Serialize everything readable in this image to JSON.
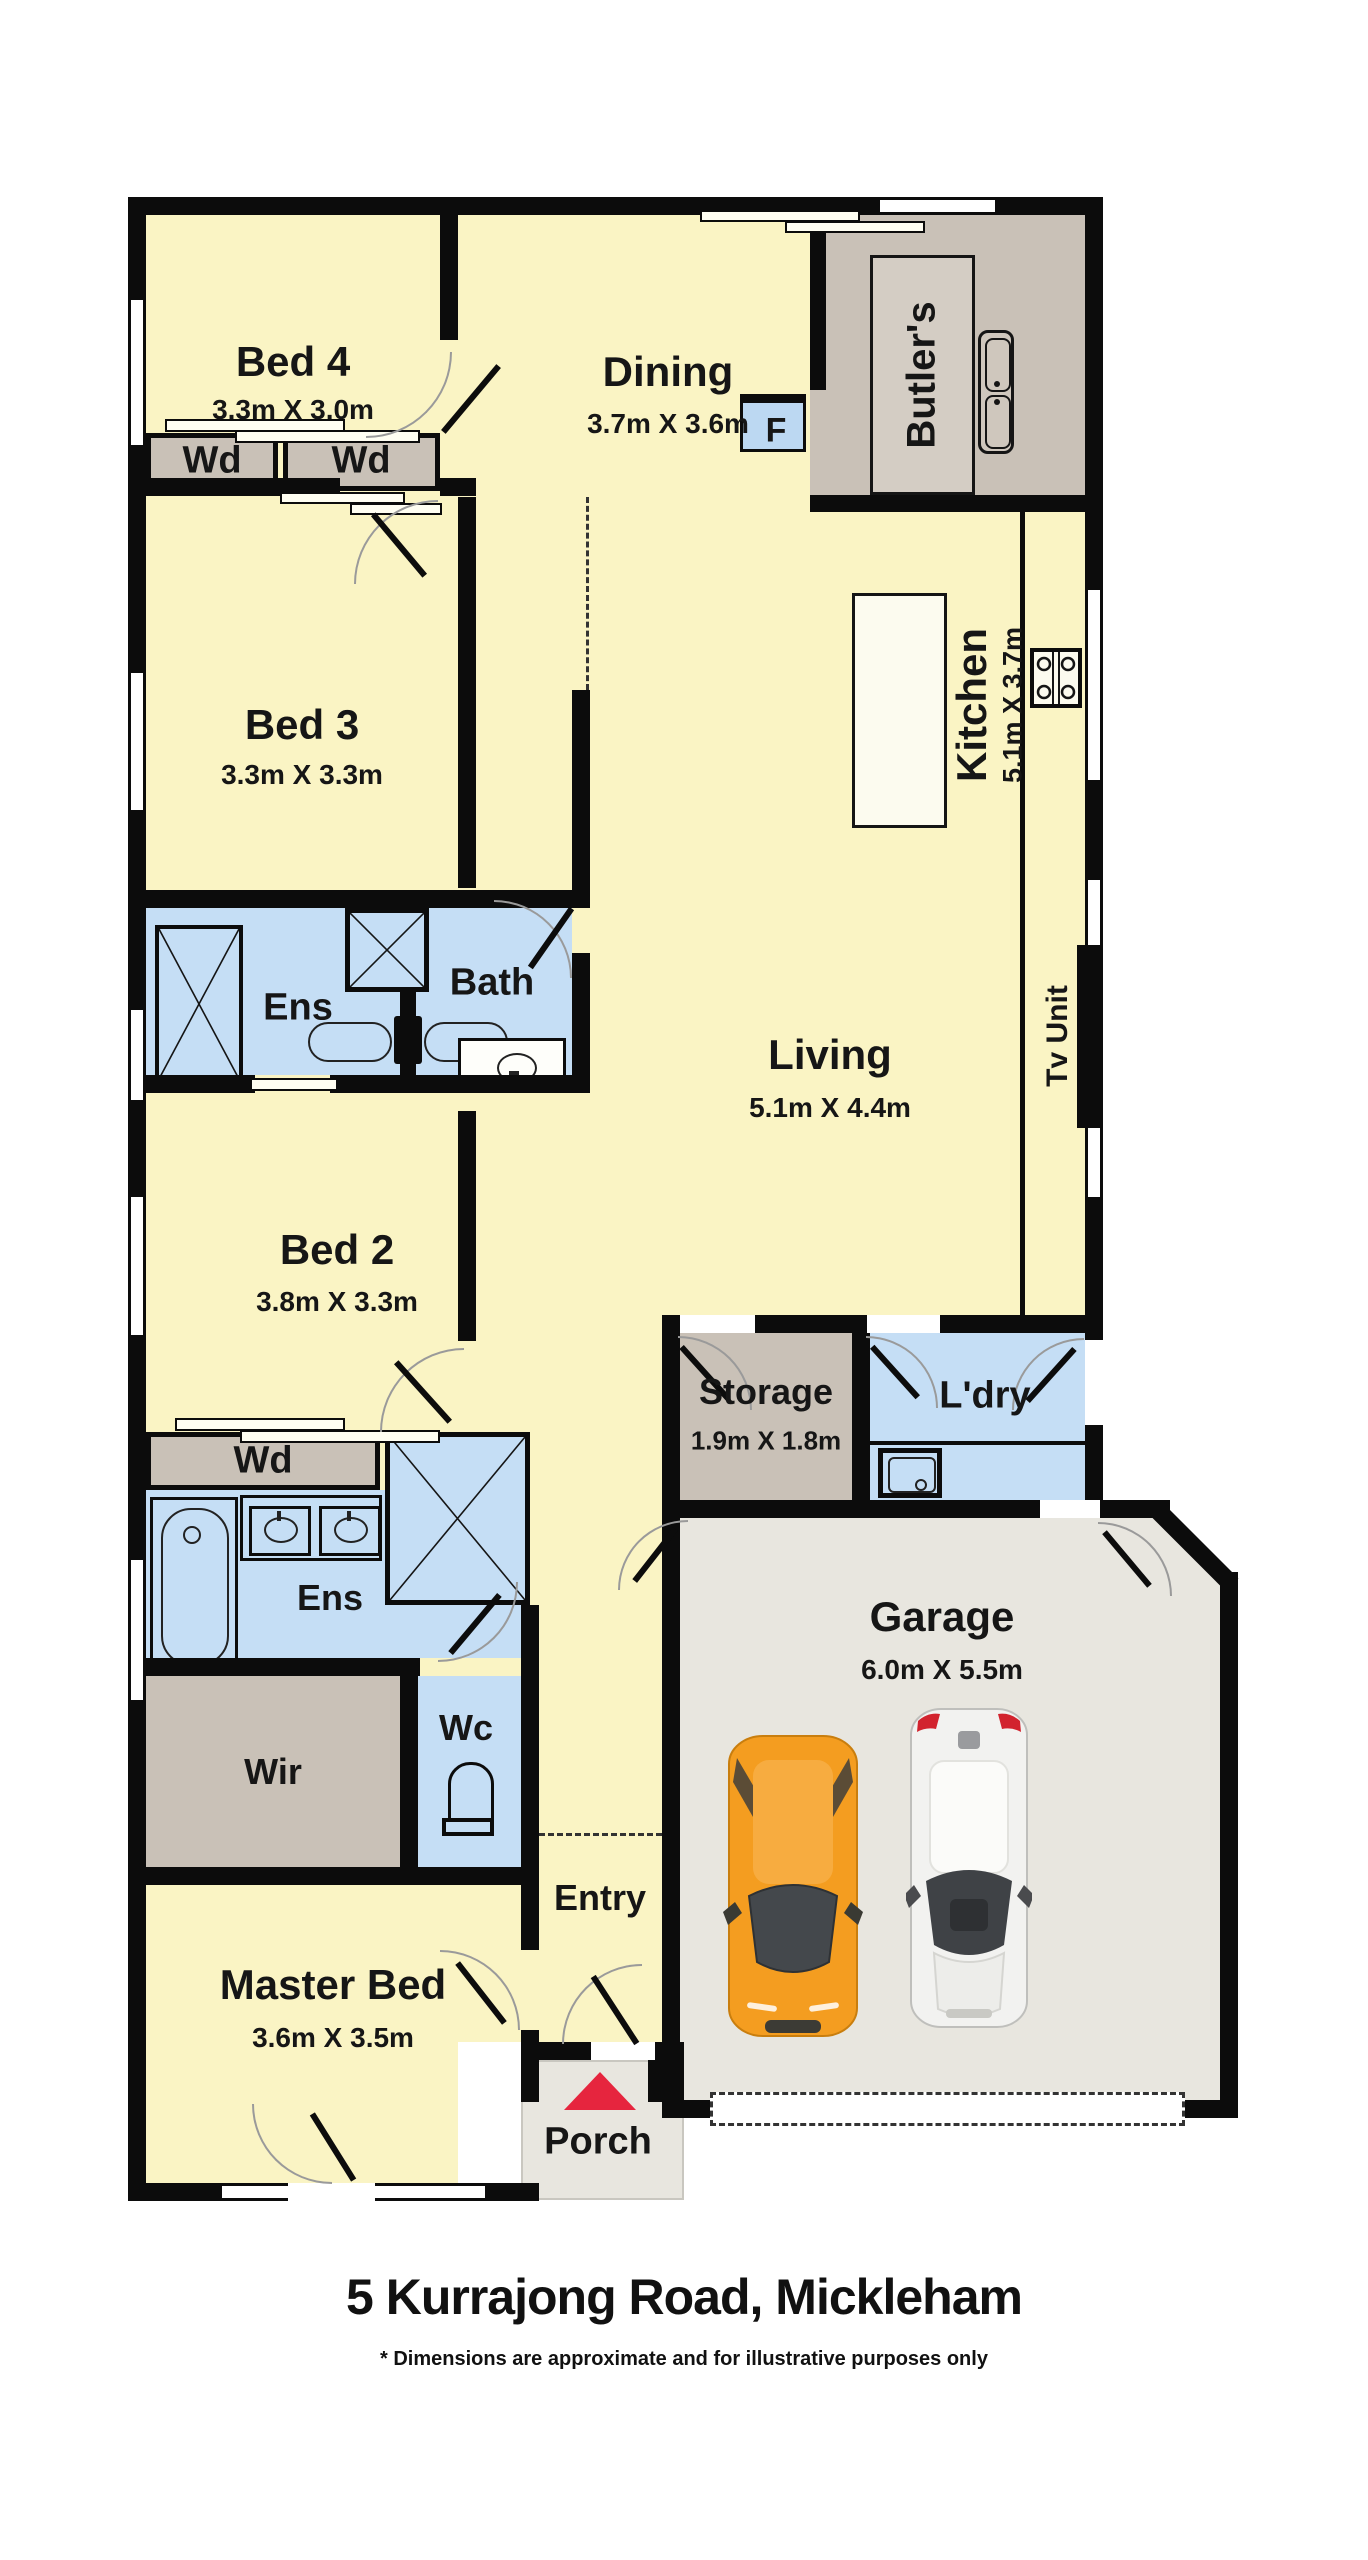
{
  "address": {
    "title": "5 Kurrajong Road, Mickleham",
    "disclaimer": "* Dimensions are approximate and for illustrative purposes only"
  },
  "rooms": {
    "bed4": {
      "label": "Bed 4",
      "dims": "3.3m X 3.0m"
    },
    "dining": {
      "label": "Dining",
      "dims": "3.7m X 3.6m"
    },
    "butlers": {
      "label": "Butler's"
    },
    "kitchen": {
      "label": "Kitchen",
      "dims": "5.1m X 3.7m"
    },
    "bed3": {
      "label": "Bed 3",
      "dims": "3.3m X 3.3m"
    },
    "ens_upper": {
      "label": "Ens"
    },
    "bath": {
      "label": "Bath"
    },
    "living": {
      "label": "Living",
      "dims": "5.1m X 4.4m"
    },
    "tv_unit": {
      "label": "Tv Unit"
    },
    "bed2": {
      "label": "Bed 2",
      "dims": "3.8m X 3.3m"
    },
    "storage": {
      "label": "Storage",
      "dims": "1.9m X 1.8m"
    },
    "laundry": {
      "label": "L'dry"
    },
    "ens_lower": {
      "label": "Ens"
    },
    "wir": {
      "label": "Wir"
    },
    "wc": {
      "label": "Wc"
    },
    "master": {
      "label": "Master Bed",
      "dims": "3.6m X 3.5m"
    },
    "entry": {
      "label": "Entry"
    },
    "porch": {
      "label": "Porch"
    },
    "garage": {
      "label": "Garage",
      "dims": "6.0m X 5.5m"
    }
  },
  "wardrobes": [
    "Wd",
    "Wd",
    "Wd"
  ],
  "fixtures": {
    "fridge_label": "F"
  },
  "cars": [
    {
      "name": "orange-car",
      "color": "#F49D20"
    },
    {
      "name": "white-car",
      "color": "#F2F2F0"
    }
  ],
  "colors": {
    "room_yellow": "#FAF4C4",
    "wet_blue": "#C5DEF5",
    "robe_grey": "#C9C1B7",
    "garage_grey": "#E8E6DF",
    "wall_black": "#0C0C0C",
    "porch_arrow_red": "#E6253E"
  }
}
